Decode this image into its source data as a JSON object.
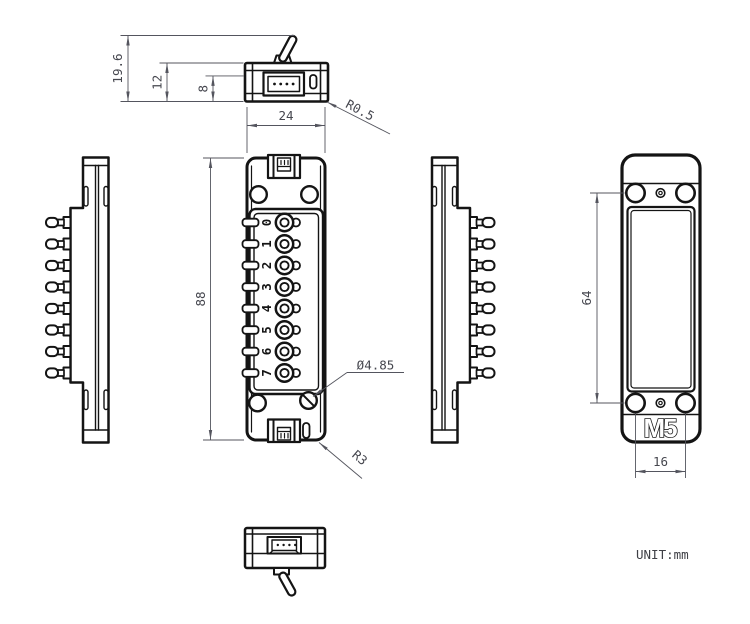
{
  "drawing": {
    "unit_note": "UNIT:mm"
  },
  "dimensions": {
    "overall_height": "19.6",
    "body_height": "12",
    "connector_opening_height": "8",
    "body_width": "24",
    "body_length": "88",
    "edge_radius": "R0.5",
    "terminal_hole_diameter": "Ø4.85",
    "corner_radius": "R3",
    "mount_hole_pitch_vertical": "64",
    "mount_hole_pitch_horizontal": "16"
  },
  "front_view": {
    "terminal_labels": [
      "0",
      "1",
      "2",
      "3",
      "4",
      "5",
      "6",
      "7"
    ]
  },
  "back_view": {
    "logo_text": "M5"
  },
  "colors": {
    "line": "#141414",
    "dimension": "#54555e",
    "background": "#ffffff"
  }
}
